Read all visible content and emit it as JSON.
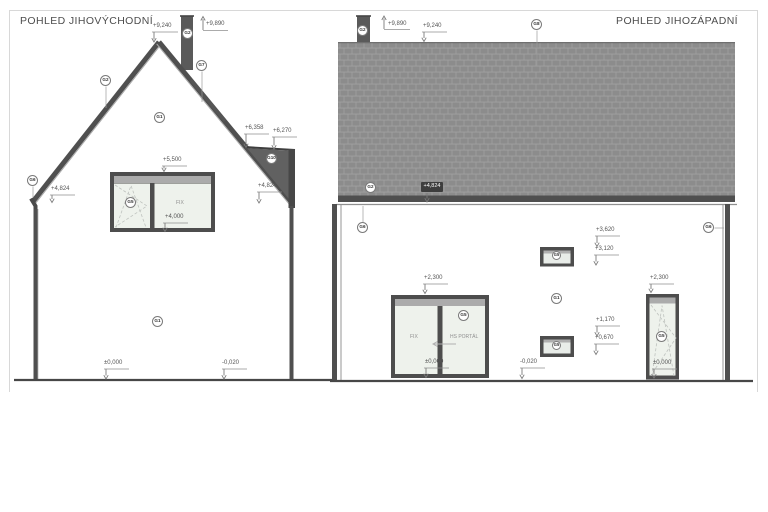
{
  "page": {
    "views": {
      "southeast": {
        "title": "POHLED JIHOVÝCHODNÍ",
        "marks": {
          "ridge": "+9,240",
          "chimney_top": "+9,890",
          "eave": "+4,824",
          "window_head": "+5,500",
          "window_sill": "+4,000",
          "annex_top_left": "+6,358",
          "annex_top_right": "+6,270",
          "annex_eave": "+4,824",
          "floor": "±0,000",
          "terrain": "-0,020"
        },
        "window_fix": "FIX"
      },
      "southwest": {
        "title": "POHLED JIHOZÁPADNÍ",
        "marks": {
          "chimney_top": "+9,890",
          "ridge": "+9,240",
          "eave_badge": "+4,824",
          "upper_window_head": "+3,620",
          "upper_window_sill": "+3,120",
          "lower_window_head": "+1,170",
          "lower_window_sill": "+0,670",
          "door_head": "+2,300",
          "door_floor": "±0,000",
          "tall_window_head": "+2,300",
          "tall_window_floor": "±0,000",
          "terrain": "-0,020"
        },
        "door_fix": "FIX",
        "door_sliding": "HS PORTÁL"
      }
    },
    "tags": {
      "g1": "G1",
      "g2": "G2",
      "g5": "G5",
      "g6": "G6",
      "g7": "G7",
      "g8": "G8",
      "g10": "G10"
    }
  }
}
